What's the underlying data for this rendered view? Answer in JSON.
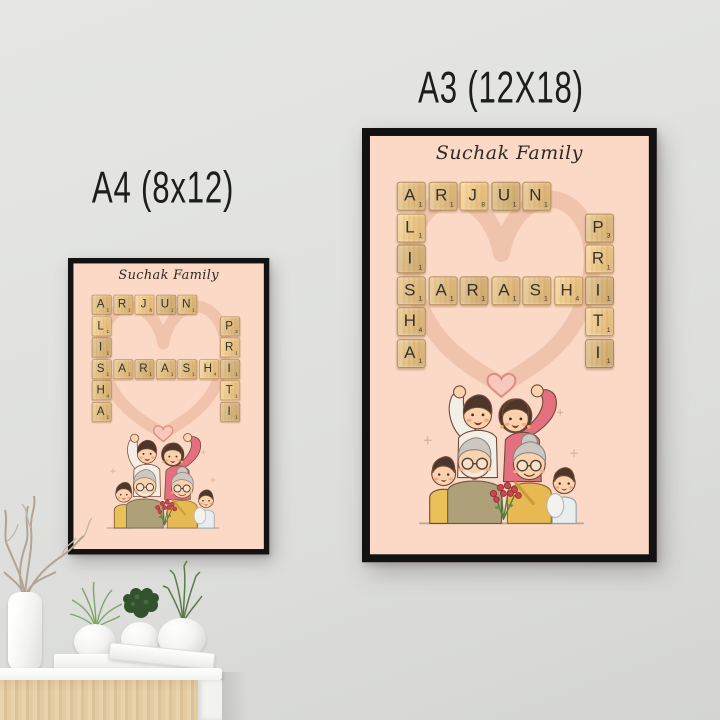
{
  "scene": {
    "size_labels": {
      "a4": "A4 (8x12)",
      "a3": "A3 (12X18)"
    }
  },
  "poster": {
    "title": "Suchak Family",
    "words": {
      "row1_across": "ARJUN",
      "col1_down": "ALISHA",
      "row4_across": "SARASHI",
      "col7_down": "PRITI"
    },
    "tiles": [
      {
        "letter": "A",
        "value": 1,
        "row": 1,
        "col": 1
      },
      {
        "letter": "R",
        "value": 1,
        "row": 1,
        "col": 2
      },
      {
        "letter": "J",
        "value": 8,
        "row": 1,
        "col": 3
      },
      {
        "letter": "U",
        "value": 1,
        "row": 1,
        "col": 4
      },
      {
        "letter": "N",
        "value": 1,
        "row": 1,
        "col": 5
      },
      {
        "letter": "L",
        "value": 1,
        "row": 2,
        "col": 1
      },
      {
        "letter": "P",
        "value": 3,
        "row": 2,
        "col": 7
      },
      {
        "letter": "I",
        "value": 1,
        "row": 3,
        "col": 1
      },
      {
        "letter": "R",
        "value": 1,
        "row": 3,
        "col": 7
      },
      {
        "letter": "S",
        "value": 1,
        "row": 4,
        "col": 1
      },
      {
        "letter": "A",
        "value": 1,
        "row": 4,
        "col": 2
      },
      {
        "letter": "R",
        "value": 1,
        "row": 4,
        "col": 3
      },
      {
        "letter": "A",
        "value": 1,
        "row": 4,
        "col": 4
      },
      {
        "letter": "S",
        "value": 1,
        "row": 4,
        "col": 5
      },
      {
        "letter": "H",
        "value": 4,
        "row": 4,
        "col": 6
      },
      {
        "letter": "I",
        "value": 1,
        "row": 4,
        "col": 7
      },
      {
        "letter": "H",
        "value": 4,
        "row": 5,
        "col": 1
      },
      {
        "letter": "T",
        "value": 1,
        "row": 5,
        "col": 7
      },
      {
        "letter": "A",
        "value": 1,
        "row": 6,
        "col": 1
      },
      {
        "letter": "I",
        "value": 1,
        "row": 6,
        "col": 7
      }
    ]
  },
  "palette": {
    "wall": "#e0e1df",
    "posterbg": "#fbd9c6",
    "frame": "#121212",
    "heart_outline": "#eec0a8",
    "heart_fill": "#f9c8bd",
    "tilewood": "#e6c48f",
    "tileink": "#35312c",
    "wood_front": "#e2cb9f",
    "plant_green_light": "#7fa766",
    "plant_green_dark": "#32512d",
    "plant_green_mid": "#5a7c4a"
  }
}
